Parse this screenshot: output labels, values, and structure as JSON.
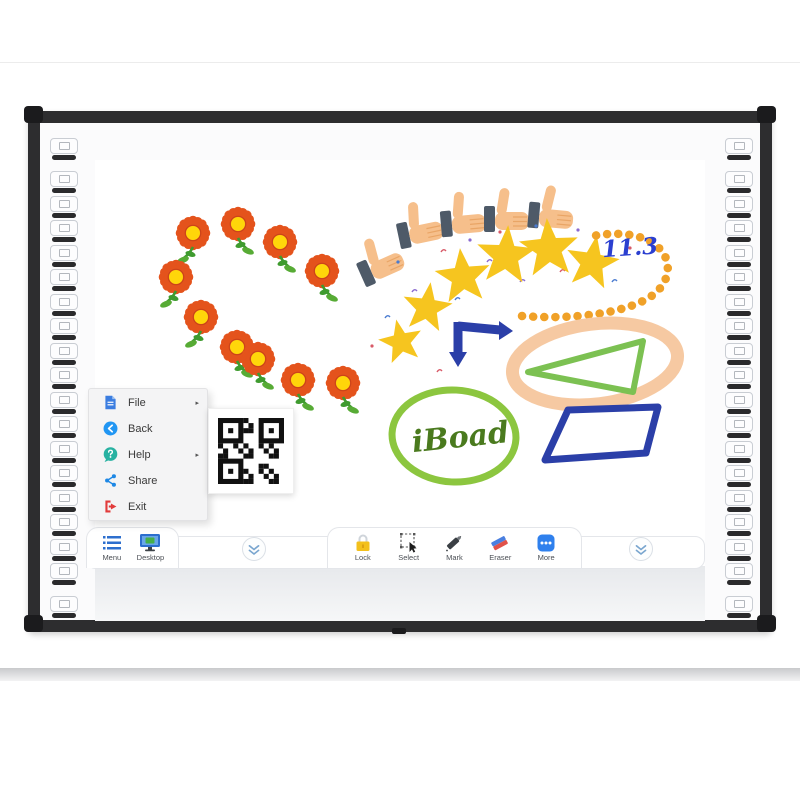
{
  "canvas": {
    "annotation": "11.3",
    "handwriting": "iBoad",
    "flowers": [
      [
        193,
        233,
        -1
      ],
      [
        238,
        224,
        1
      ],
      [
        280,
        242,
        1
      ],
      [
        322,
        271,
        1
      ],
      [
        176,
        277,
        -1
      ],
      [
        201,
        317,
        -1
      ],
      [
        237,
        347,
        1
      ],
      [
        258,
        359,
        1
      ],
      [
        298,
        380,
        1
      ],
      [
        343,
        383,
        1
      ]
    ],
    "thumbs": [
      [
        383,
        256,
        -24
      ],
      [
        424,
        222,
        -12
      ],
      [
        468,
        213,
        -5
      ],
      [
        512,
        210,
        0
      ],
      [
        557,
        208,
        5
      ]
    ],
    "stars": [
      [
        401,
        342,
        46,
        -12
      ],
      [
        427,
        308,
        52,
        8
      ],
      [
        463,
        277,
        58,
        -6
      ],
      [
        506,
        256,
        62,
        4
      ],
      [
        549,
        249,
        62,
        -4
      ],
      [
        592,
        263,
        56,
        10
      ]
    ],
    "confetti": [
      [
        385,
        318,
        0
      ],
      [
        372,
        346,
        1
      ],
      [
        412,
        292,
        2
      ],
      [
        398,
        262,
        0
      ],
      [
        441,
        252,
        1
      ],
      [
        470,
        240,
        2
      ],
      [
        455,
        300,
        0
      ],
      [
        500,
        232,
        1
      ],
      [
        520,
        282,
        2
      ],
      [
        536,
        226,
        0
      ],
      [
        560,
        272,
        1
      ],
      [
        578,
        230,
        2
      ],
      [
        612,
        282,
        0
      ],
      [
        630,
        248,
        1
      ],
      [
        487,
        262,
        2
      ],
      [
        530,
        250,
        0
      ],
      [
        437,
        372,
        1
      ]
    ],
    "confetti_colors": [
      "#4a7bd0",
      "#d85a68",
      "#8a6ad0"
    ]
  },
  "menu": {
    "items": [
      {
        "label": "File",
        "icon": "file-icon",
        "arrow": "▸"
      },
      {
        "label": "Back",
        "icon": "back-icon",
        "arrow": ""
      },
      {
        "label": "Help",
        "icon": "help-icon",
        "arrow": "▸"
      },
      {
        "label": "Share",
        "icon": "share-icon",
        "arrow": ""
      },
      {
        "label": "Exit",
        "icon": "exit-icon",
        "arrow": ""
      }
    ]
  },
  "dock": {
    "left": [
      {
        "label": "Menu"
      },
      {
        "label": "Desktop"
      }
    ],
    "center": [
      {
        "label": "Lock"
      },
      {
        "label": "Select"
      },
      {
        "label": "Mark"
      },
      {
        "label": "Eraser"
      },
      {
        "label": "More"
      }
    ]
  },
  "hotkeys": {
    "per_side": 19
  },
  "colors": {
    "frame": "#2d2d2f",
    "accent_blue": "#2d6fce",
    "star_gold": "#f6c51f",
    "flower_orange": "#e4531c",
    "loop_peach": "#f6c9a2",
    "shape_blue": "#2b3fa8",
    "triangle_green": "#7cc152",
    "ellipse_green": "#8cc63f",
    "bead_orange": "#f0a128",
    "lock_yellow": "#f3c01c",
    "eraser_red": "#e0524a",
    "exit_red": "#e23b3b"
  }
}
